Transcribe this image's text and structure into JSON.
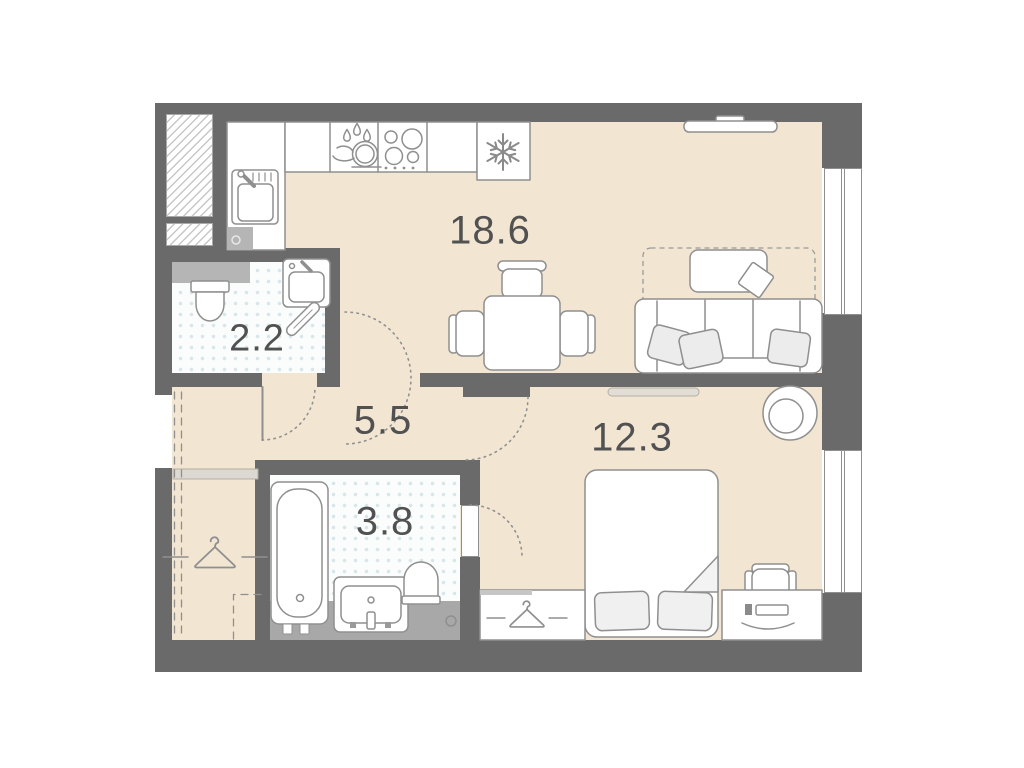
{
  "floor_plan": {
    "room_labels": [
      {
        "id": "kitchen-living",
        "area": "18.6"
      },
      {
        "id": "bathroom-small",
        "area": "2.2"
      },
      {
        "id": "hallway",
        "area": "5.5"
      },
      {
        "id": "bedroom",
        "area": "12.3"
      },
      {
        "id": "bathroom-large",
        "area": "3.8"
      }
    ],
    "icons": [
      "vent-shaft-hatch-icon",
      "kitchen-sink-icon",
      "dishwasher-icon",
      "cooktop-icon",
      "fridge-snowflake-icon",
      "tv-icon",
      "dining-table-icon",
      "chair-icon",
      "sofa-icon",
      "pillow-icon",
      "coffee-table-icon",
      "rug-icon",
      "radiator-icon",
      "toilet-icon",
      "washbasin-icon",
      "towel-rail-icon",
      "bathtub-icon",
      "drain-icon",
      "hanger-icon",
      "bed-icon",
      "blanket-fold-icon",
      "desk-icon",
      "desk-chair-icon",
      "armchair-icon",
      "door-swing-arc-icon",
      "window-icon"
    ],
    "colors": {
      "wall": "#6a6a6a",
      "floor": "#f2e6d3",
      "tile": "#fbfdfd",
      "tile_dot": "#d9e6e9",
      "outline": "#8f8f8f",
      "label_text": "#515151",
      "gray_fixture": "#a8a8a8"
    }
  }
}
